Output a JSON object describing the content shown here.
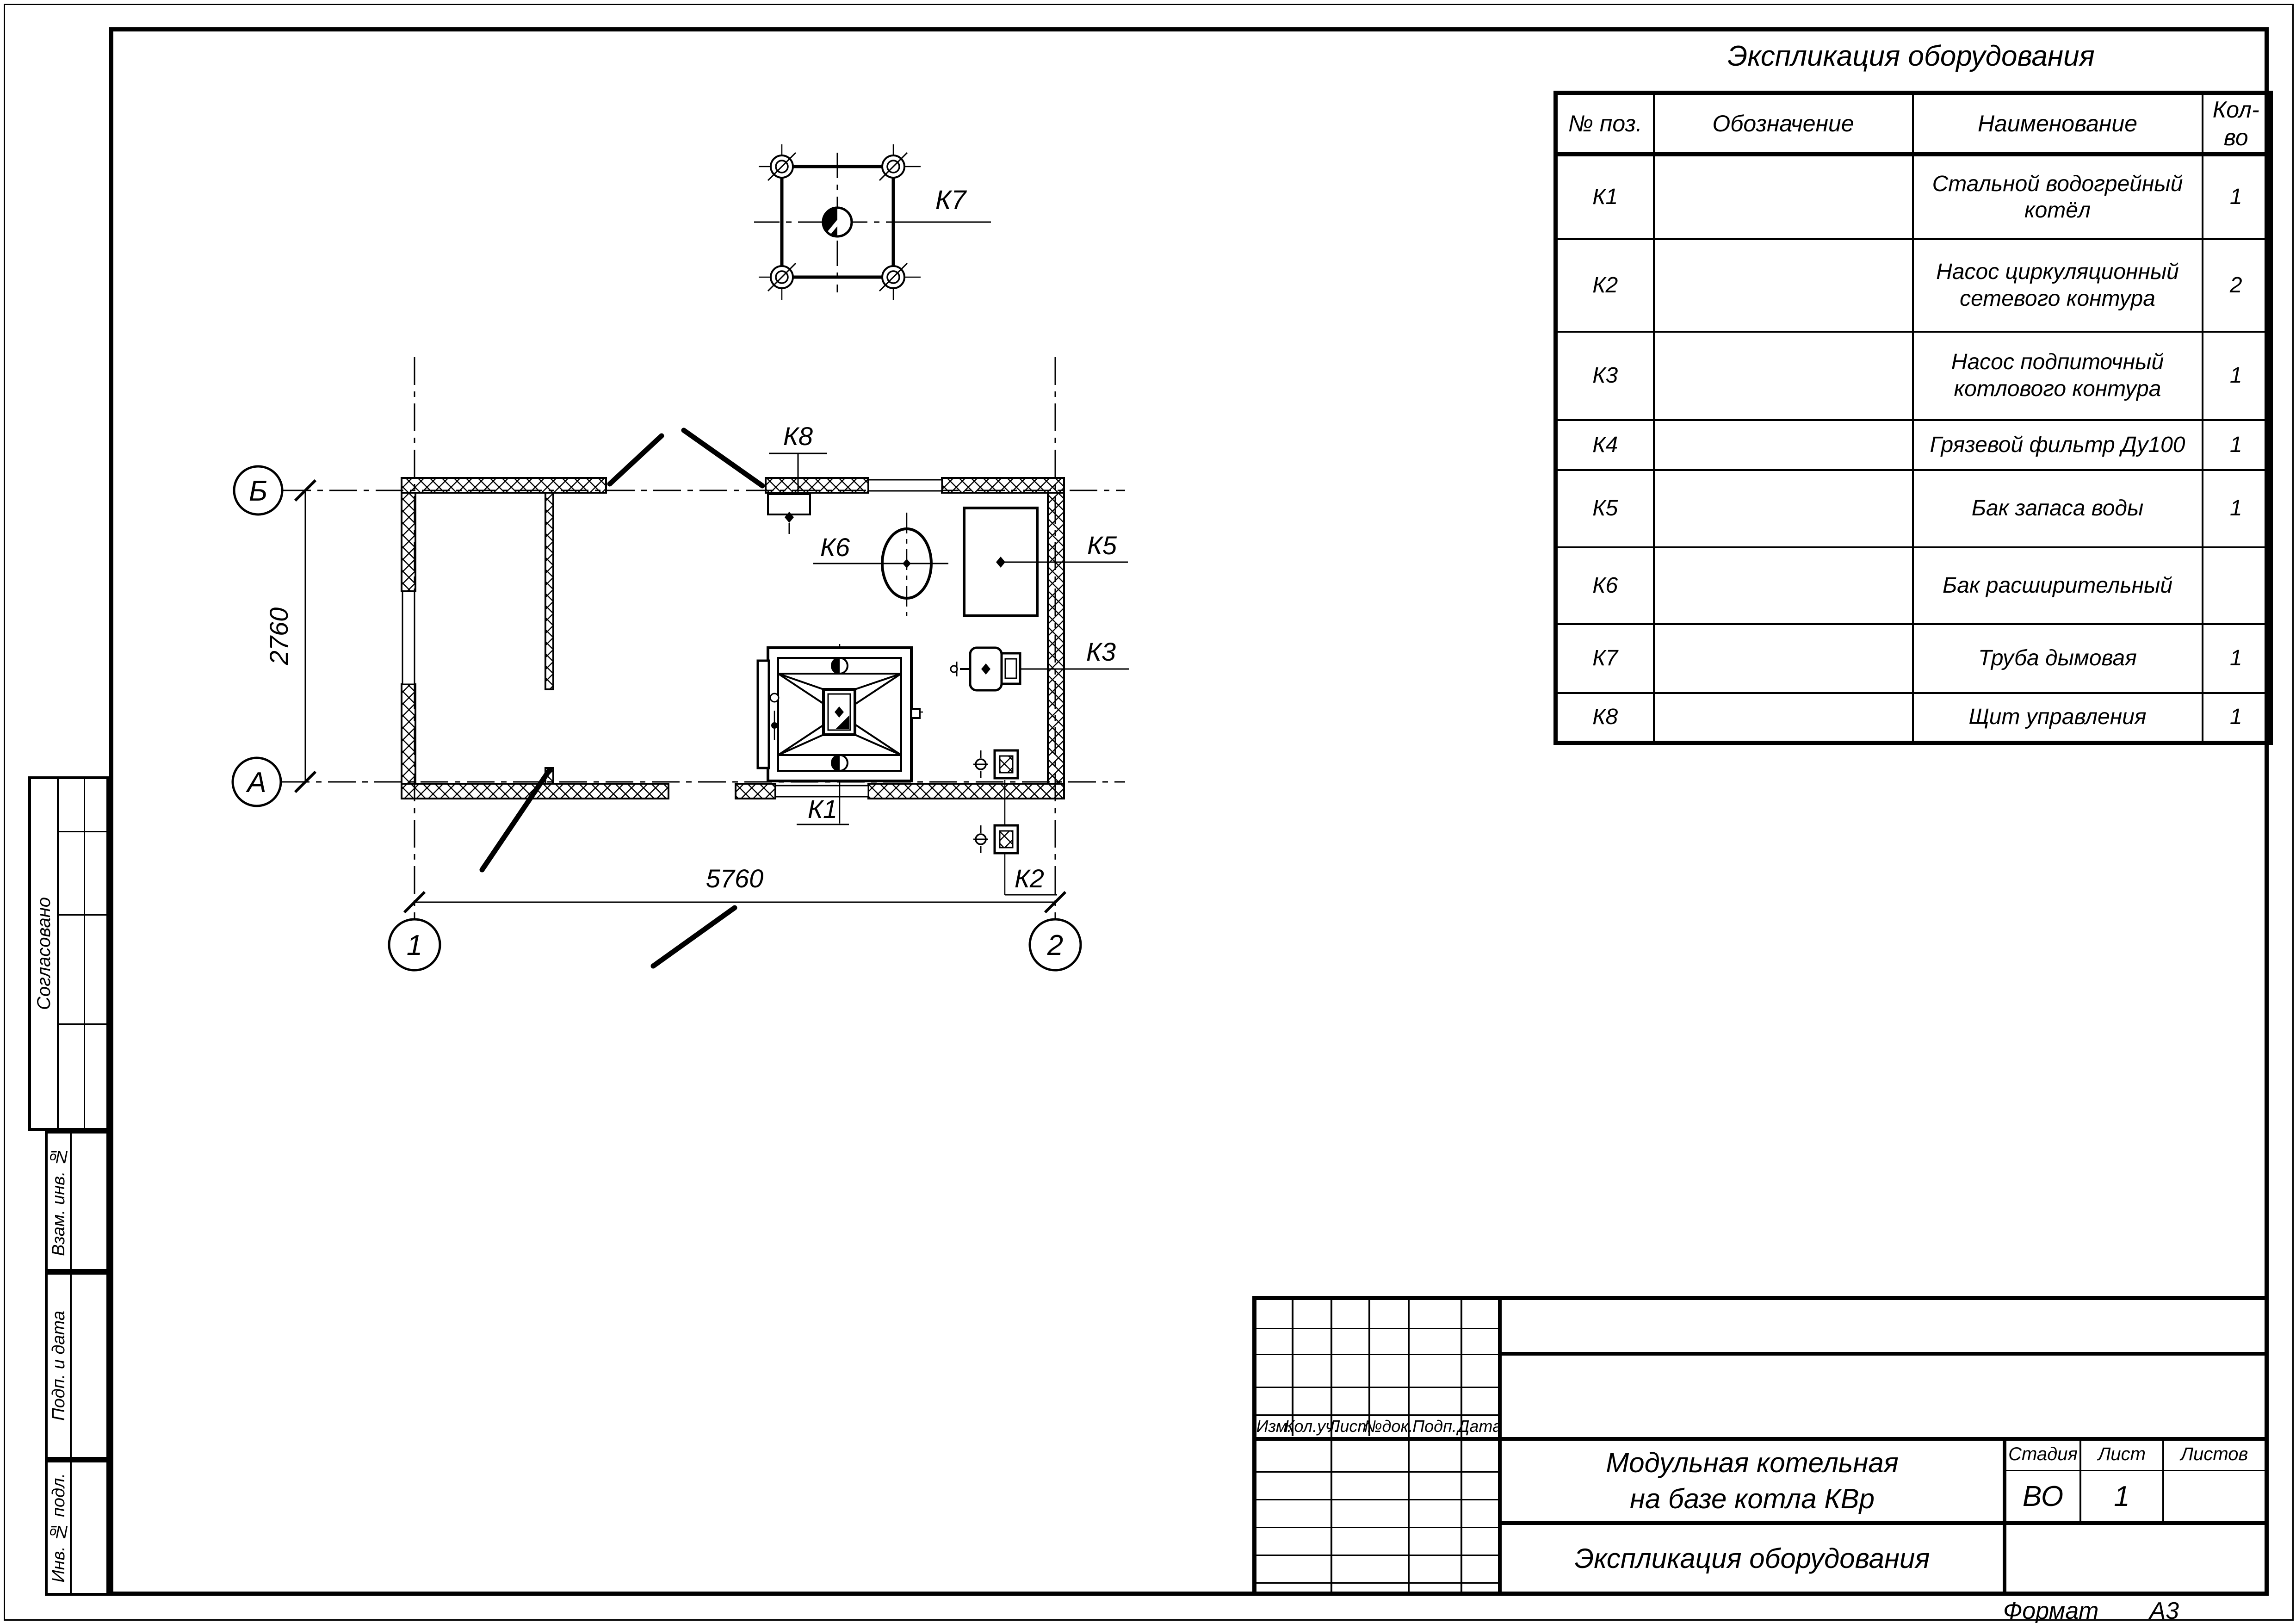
{
  "page": {
    "format_label": "Формат",
    "format_value": "А3"
  },
  "equipment_table": {
    "title": "Экспликация оборудования",
    "columns": [
      "№ поз.",
      "Обозначение",
      "Наименование",
      "Кол-во"
    ],
    "rows": [
      {
        "pos": "К1",
        "designation": "",
        "name": "Стальной водогрейный котёл",
        "qty": "1"
      },
      {
        "pos": "К2",
        "designation": "",
        "name": "Насос циркуляционный сетевого контура",
        "qty": "2"
      },
      {
        "pos": "К3",
        "designation": "",
        "name": "Насос подпиточный котлового контура",
        "qty": "1"
      },
      {
        "pos": "К4",
        "designation": "",
        "name": "Грязевой фильтр Ду100",
        "qty": "1"
      },
      {
        "pos": "К5",
        "designation": "",
        "name": "Бак запаса воды",
        "qty": "1"
      },
      {
        "pos": "К6",
        "designation": "",
        "name": "Бак расширительный",
        "qty": ""
      },
      {
        "pos": "К7",
        "designation": "",
        "name": "Труба дымовая",
        "qty": "1"
      },
      {
        "pos": "К8",
        "designation": "",
        "name": "Щит управления",
        "qty": "1"
      }
    ]
  },
  "plan": {
    "axis_labels": {
      "b": "Б",
      "a": "А",
      "one": "1",
      "two": "2"
    },
    "dimensions": {
      "width": "5760",
      "height": "2760"
    },
    "equipment_tags": {
      "k1": "К1",
      "k2": "К2",
      "k3": "К3",
      "k5": "К5",
      "k6": "К6",
      "k7": "К7",
      "k8": "К8"
    }
  },
  "title_block": {
    "project_title_line1": "Модульная котельная",
    "project_title_line2": "на базе котла КВр",
    "sheet_title": "Экспликация оборудования",
    "stage_label": "Стадия",
    "stage_value": "ВО",
    "sheet_label": "Лист",
    "sheet_value": "1",
    "sheets_label": "Листов",
    "sheets_value": "",
    "revision_headers": [
      "Изм.",
      "Кол.уч.",
      "Лист",
      "№док.",
      "Подп.",
      "Дата"
    ]
  },
  "side_panel": {
    "agreed": "Согласовано",
    "replacement_inv": "Взам. инв. №",
    "signature_date": "Подп. и дата",
    "inventory_original": "Инв. № подл."
  }
}
